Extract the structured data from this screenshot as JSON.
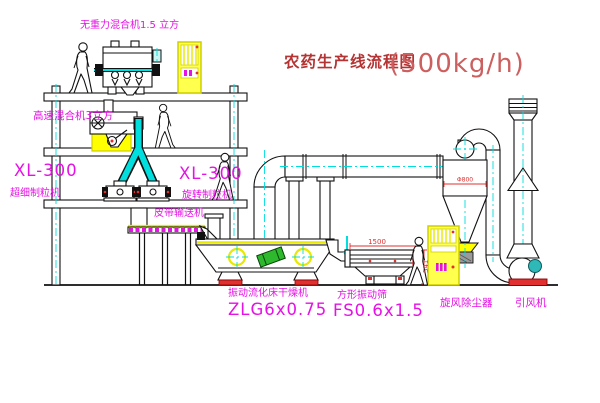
{
  "title": {
    "text": "农药生产线流程图",
    "capacity": "(500kg/h)"
  },
  "equipment_labels": {
    "gravity_mixer": "无重力混合机1.5 立方",
    "high_speed_mixer": "高速混合机3立方",
    "granulator_left": {
      "model": "XL-300",
      "name": "超细制粒机"
    },
    "granulator_right": {
      "model": "XL-300",
      "name": "旋转制粒机"
    },
    "belt_conveyor": "皮带输送机",
    "fluid_bed_dryer": {
      "name": "振动流化床干燥机",
      "model": "ZLG6x0.75"
    },
    "vibrating_screen": {
      "name": "方形振动筛",
      "model": "FS0.6x1.5"
    },
    "cyclone": "旋风除尘器",
    "induced_draft_fan": "引风机"
  },
  "dimensions": {
    "screen_length": "1500",
    "screen_height": "541",
    "cyclone_dia": "Φ800"
  },
  "colors": {
    "label_magenta": "#e511e5",
    "title_red": "#b53333",
    "centerline_cyan": "#00dede",
    "highlight_yellow": "#ffff00",
    "accent_red": "#e03030",
    "motor_green": "#2eb82e",
    "fan_motor_teal": "#2fb8b8",
    "line": "#111111"
  }
}
